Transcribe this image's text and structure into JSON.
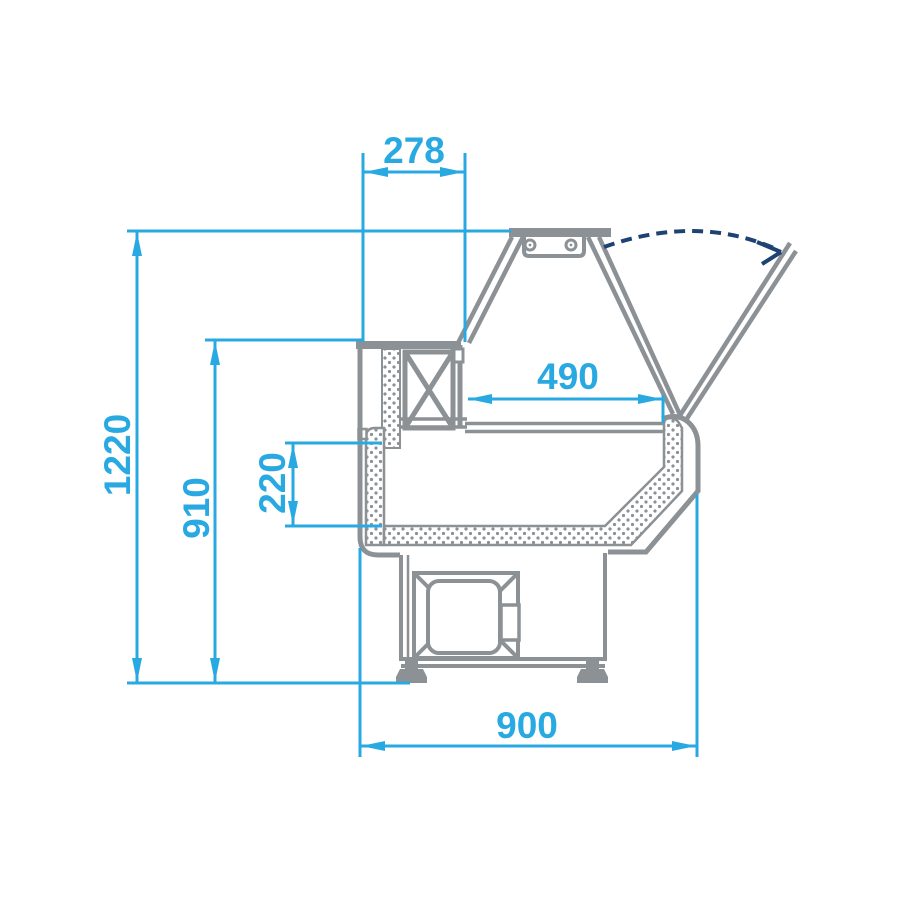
{
  "diagram": {
    "type": "technical_drawing",
    "subject": "Side cross-section of a refrigerated serve-over display counter with lift-up front glass",
    "units": "mm",
    "colors": {
      "dimension_blue": "#29A9E1",
      "outline_gray": "#8C9196",
      "swing_arc_navy": "#1E4273",
      "background": "#FFFFFF"
    },
    "dimensions": {
      "top_width": {
        "value": "278",
        "orientation": "horizontal",
        "location": "top rear section width"
      },
      "overall_height": {
        "value": "1220",
        "orientation": "vertical",
        "location": "floor to top of canopy"
      },
      "body_height": {
        "value": "910",
        "orientation": "vertical",
        "location": "floor to rear worktop"
      },
      "well_depth": {
        "value": "220",
        "orientation": "vertical",
        "location": "display well depth"
      },
      "display_depth": {
        "value": "490",
        "orientation": "horizontal",
        "location": "display shelf depth"
      },
      "overall_depth": {
        "value": "900",
        "orientation": "horizontal",
        "location": "overall counter depth"
      }
    },
    "annotations": {
      "glass_swing": "dashed arc with arrow showing front glass opening travel"
    }
  }
}
